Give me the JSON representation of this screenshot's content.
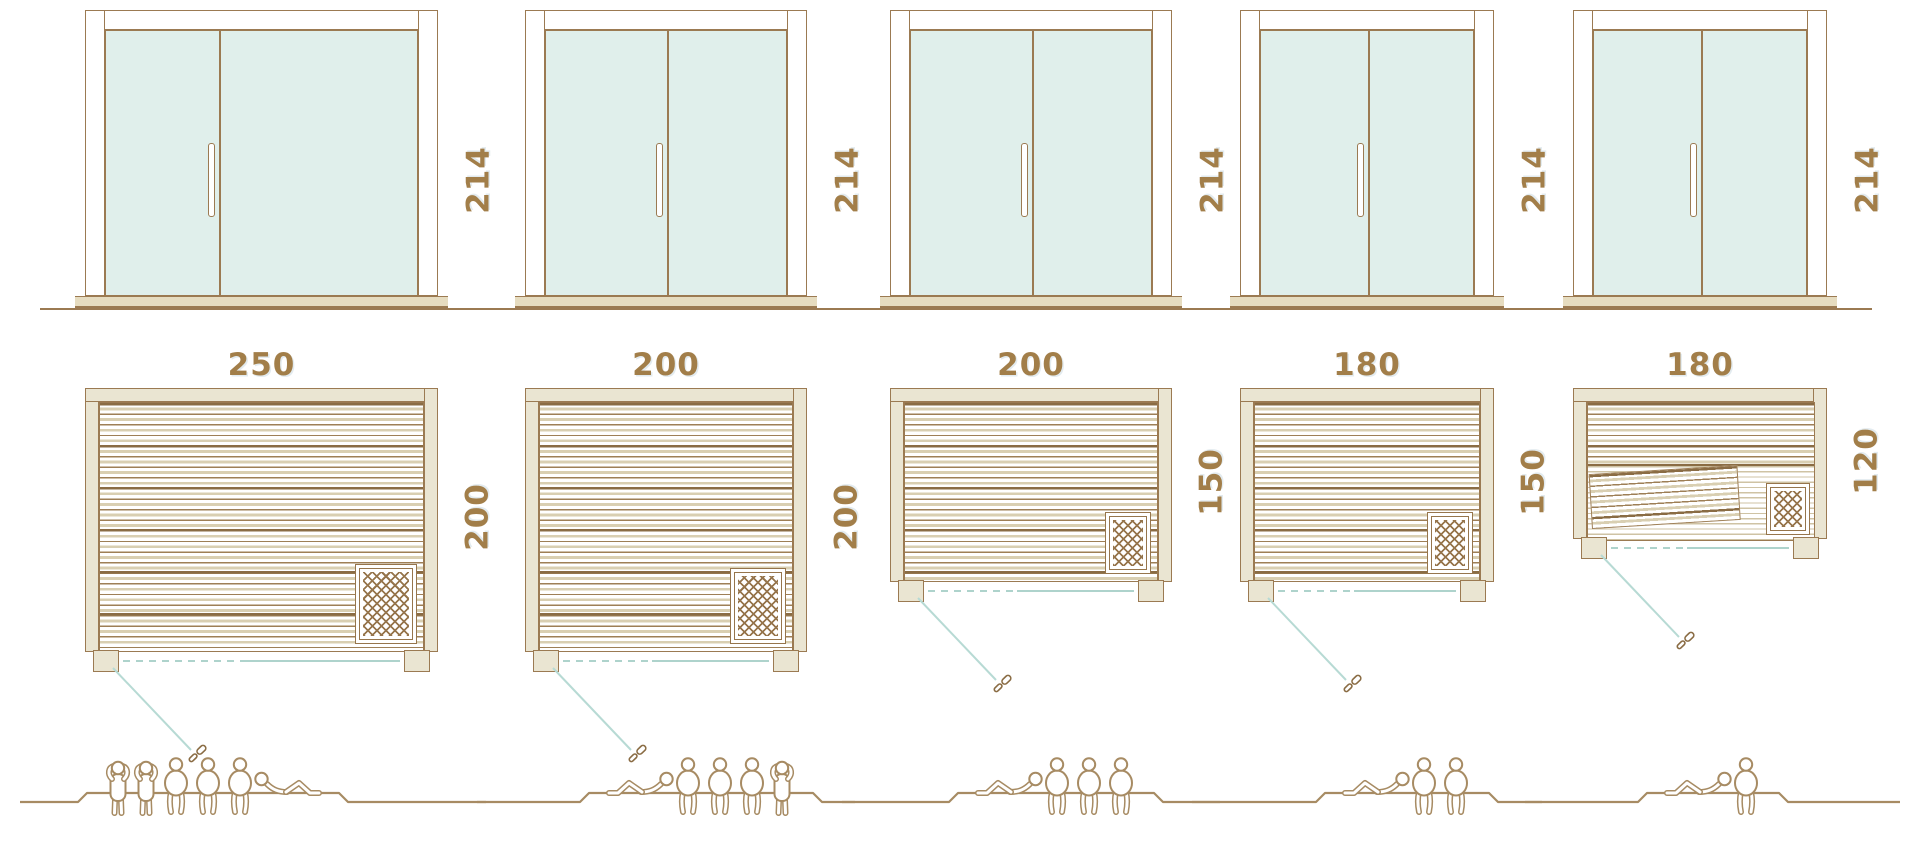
{
  "palette": {
    "line_brown": "#9b7a52",
    "label_brown": "#a27e49",
    "wall_fill": "#eae5d2",
    "glass_fill": "#e0efeb",
    "glass_front_teal": "#aed3cc",
    "people_brown": "#a78b63"
  },
  "units": [
    {
      "door_height_label": "214",
      "plan_width_label": "250",
      "plan_depth_label": "200",
      "capacity": 6,
      "people": [
        "standing",
        "standing",
        "sitting",
        "sitting",
        "sitting",
        "reclining_right"
      ],
      "has_tilted_bench": false
    },
    {
      "door_height_label": "214",
      "plan_width_label": "200",
      "plan_depth_label": "200",
      "capacity": 5,
      "people": [
        "reclining",
        "sitting",
        "sitting",
        "sitting",
        "standing"
      ],
      "has_tilted_bench": false
    },
    {
      "door_height_label": "214",
      "plan_width_label": "200",
      "plan_depth_label": "150",
      "capacity": 4,
      "people": [
        "reclining",
        "sitting",
        "sitting",
        "sitting"
      ],
      "has_tilted_bench": false
    },
    {
      "door_height_label": "214",
      "plan_width_label": "180",
      "plan_depth_label": "150",
      "capacity": 3,
      "people": [
        "reclining",
        "sitting",
        "sitting"
      ],
      "has_tilted_bench": false
    },
    {
      "door_height_label": "214",
      "plan_width_label": "180",
      "plan_depth_label": "120",
      "capacity": 2,
      "people": [
        "reclining",
        "sitting"
      ],
      "has_tilted_bench": true
    }
  ]
}
